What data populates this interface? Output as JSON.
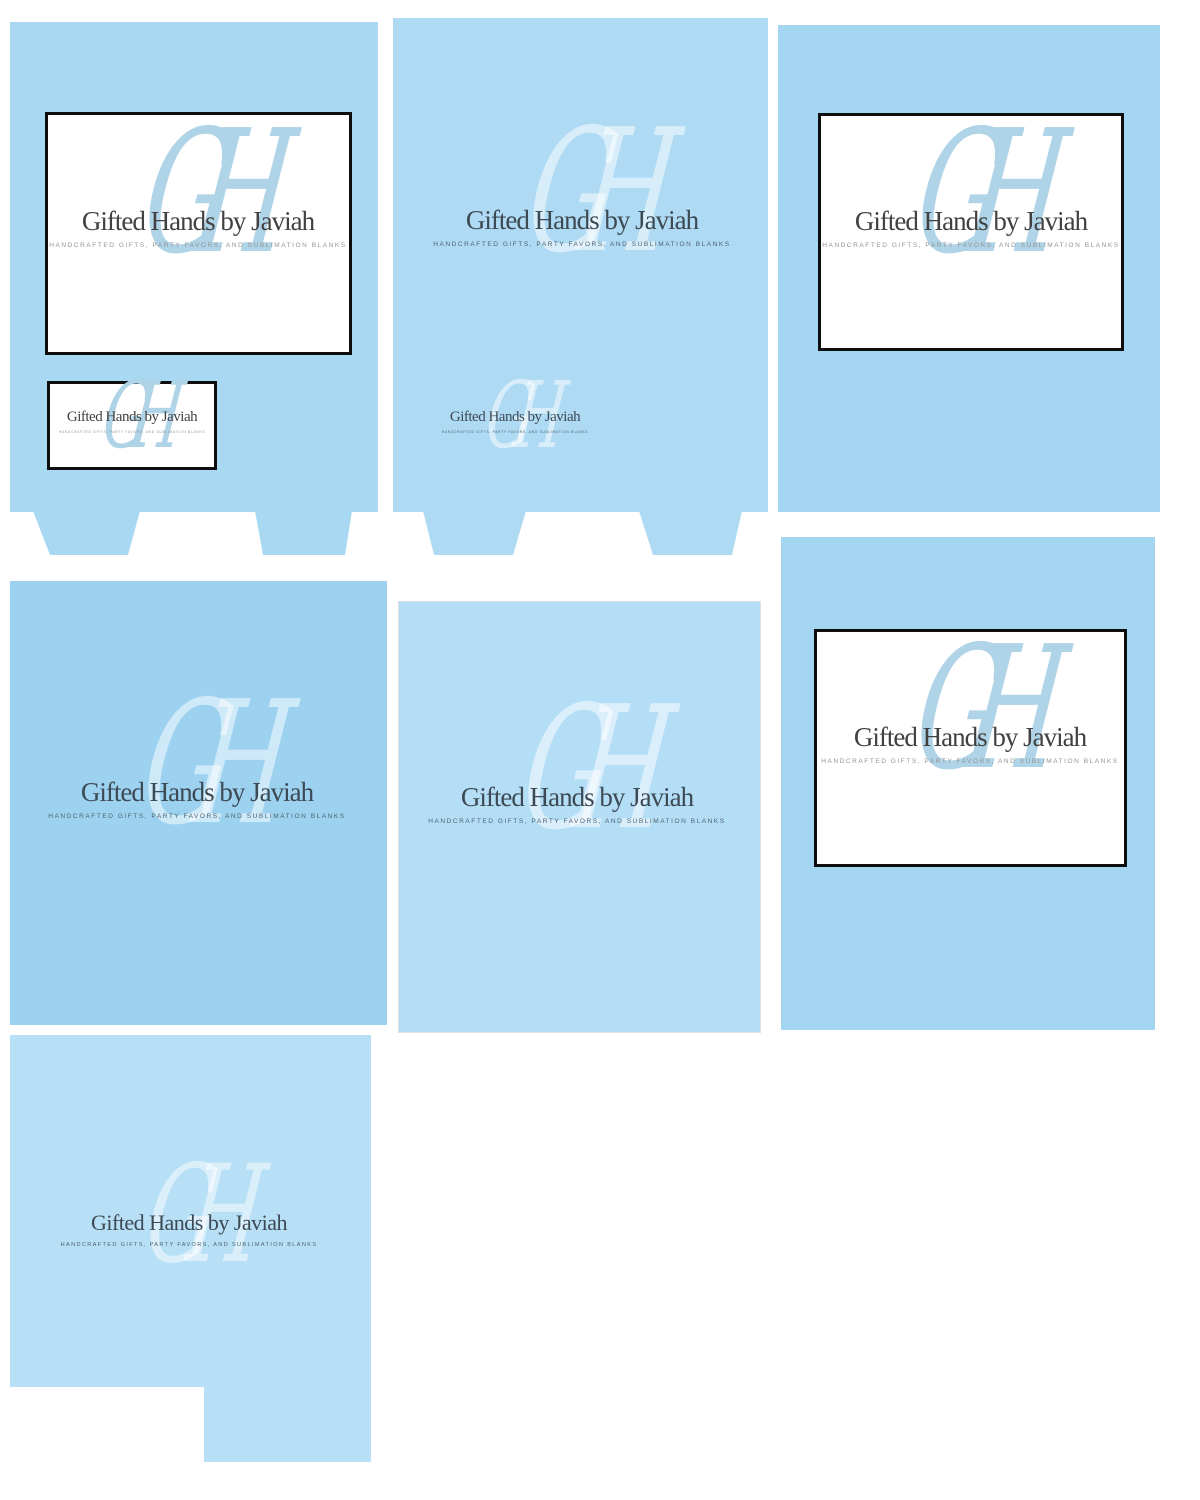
{
  "brand": {
    "title": "Gifted Hands by Javiah",
    "tagline": "HANDCRAFTED GIFTS, PARTY FAVORS, AND SUBLIMATION BLANKS",
    "monogram": "GH"
  },
  "colors": {
    "page_bg": "#ffffff",
    "panel_1": "#a9d8f3",
    "panel_2": "#afdaf4",
    "panel_3": "#a4d5f1",
    "panel_4": "#9cd2f0",
    "panel_5": "#b4def6",
    "panel_6": "#a4d5f1",
    "panel_7": "#b7dff6",
    "monogram_on_white": "#afd3e7",
    "monogram_on_blue": "rgba(255,255,255,0.5)",
    "title_on_white": "#414141",
    "title_on_blue": "#3d4a54",
    "tagline_on_white": "#949494",
    "tagline_on_blue": "#4e6370",
    "box_border": "#0e0e0e"
  }
}
